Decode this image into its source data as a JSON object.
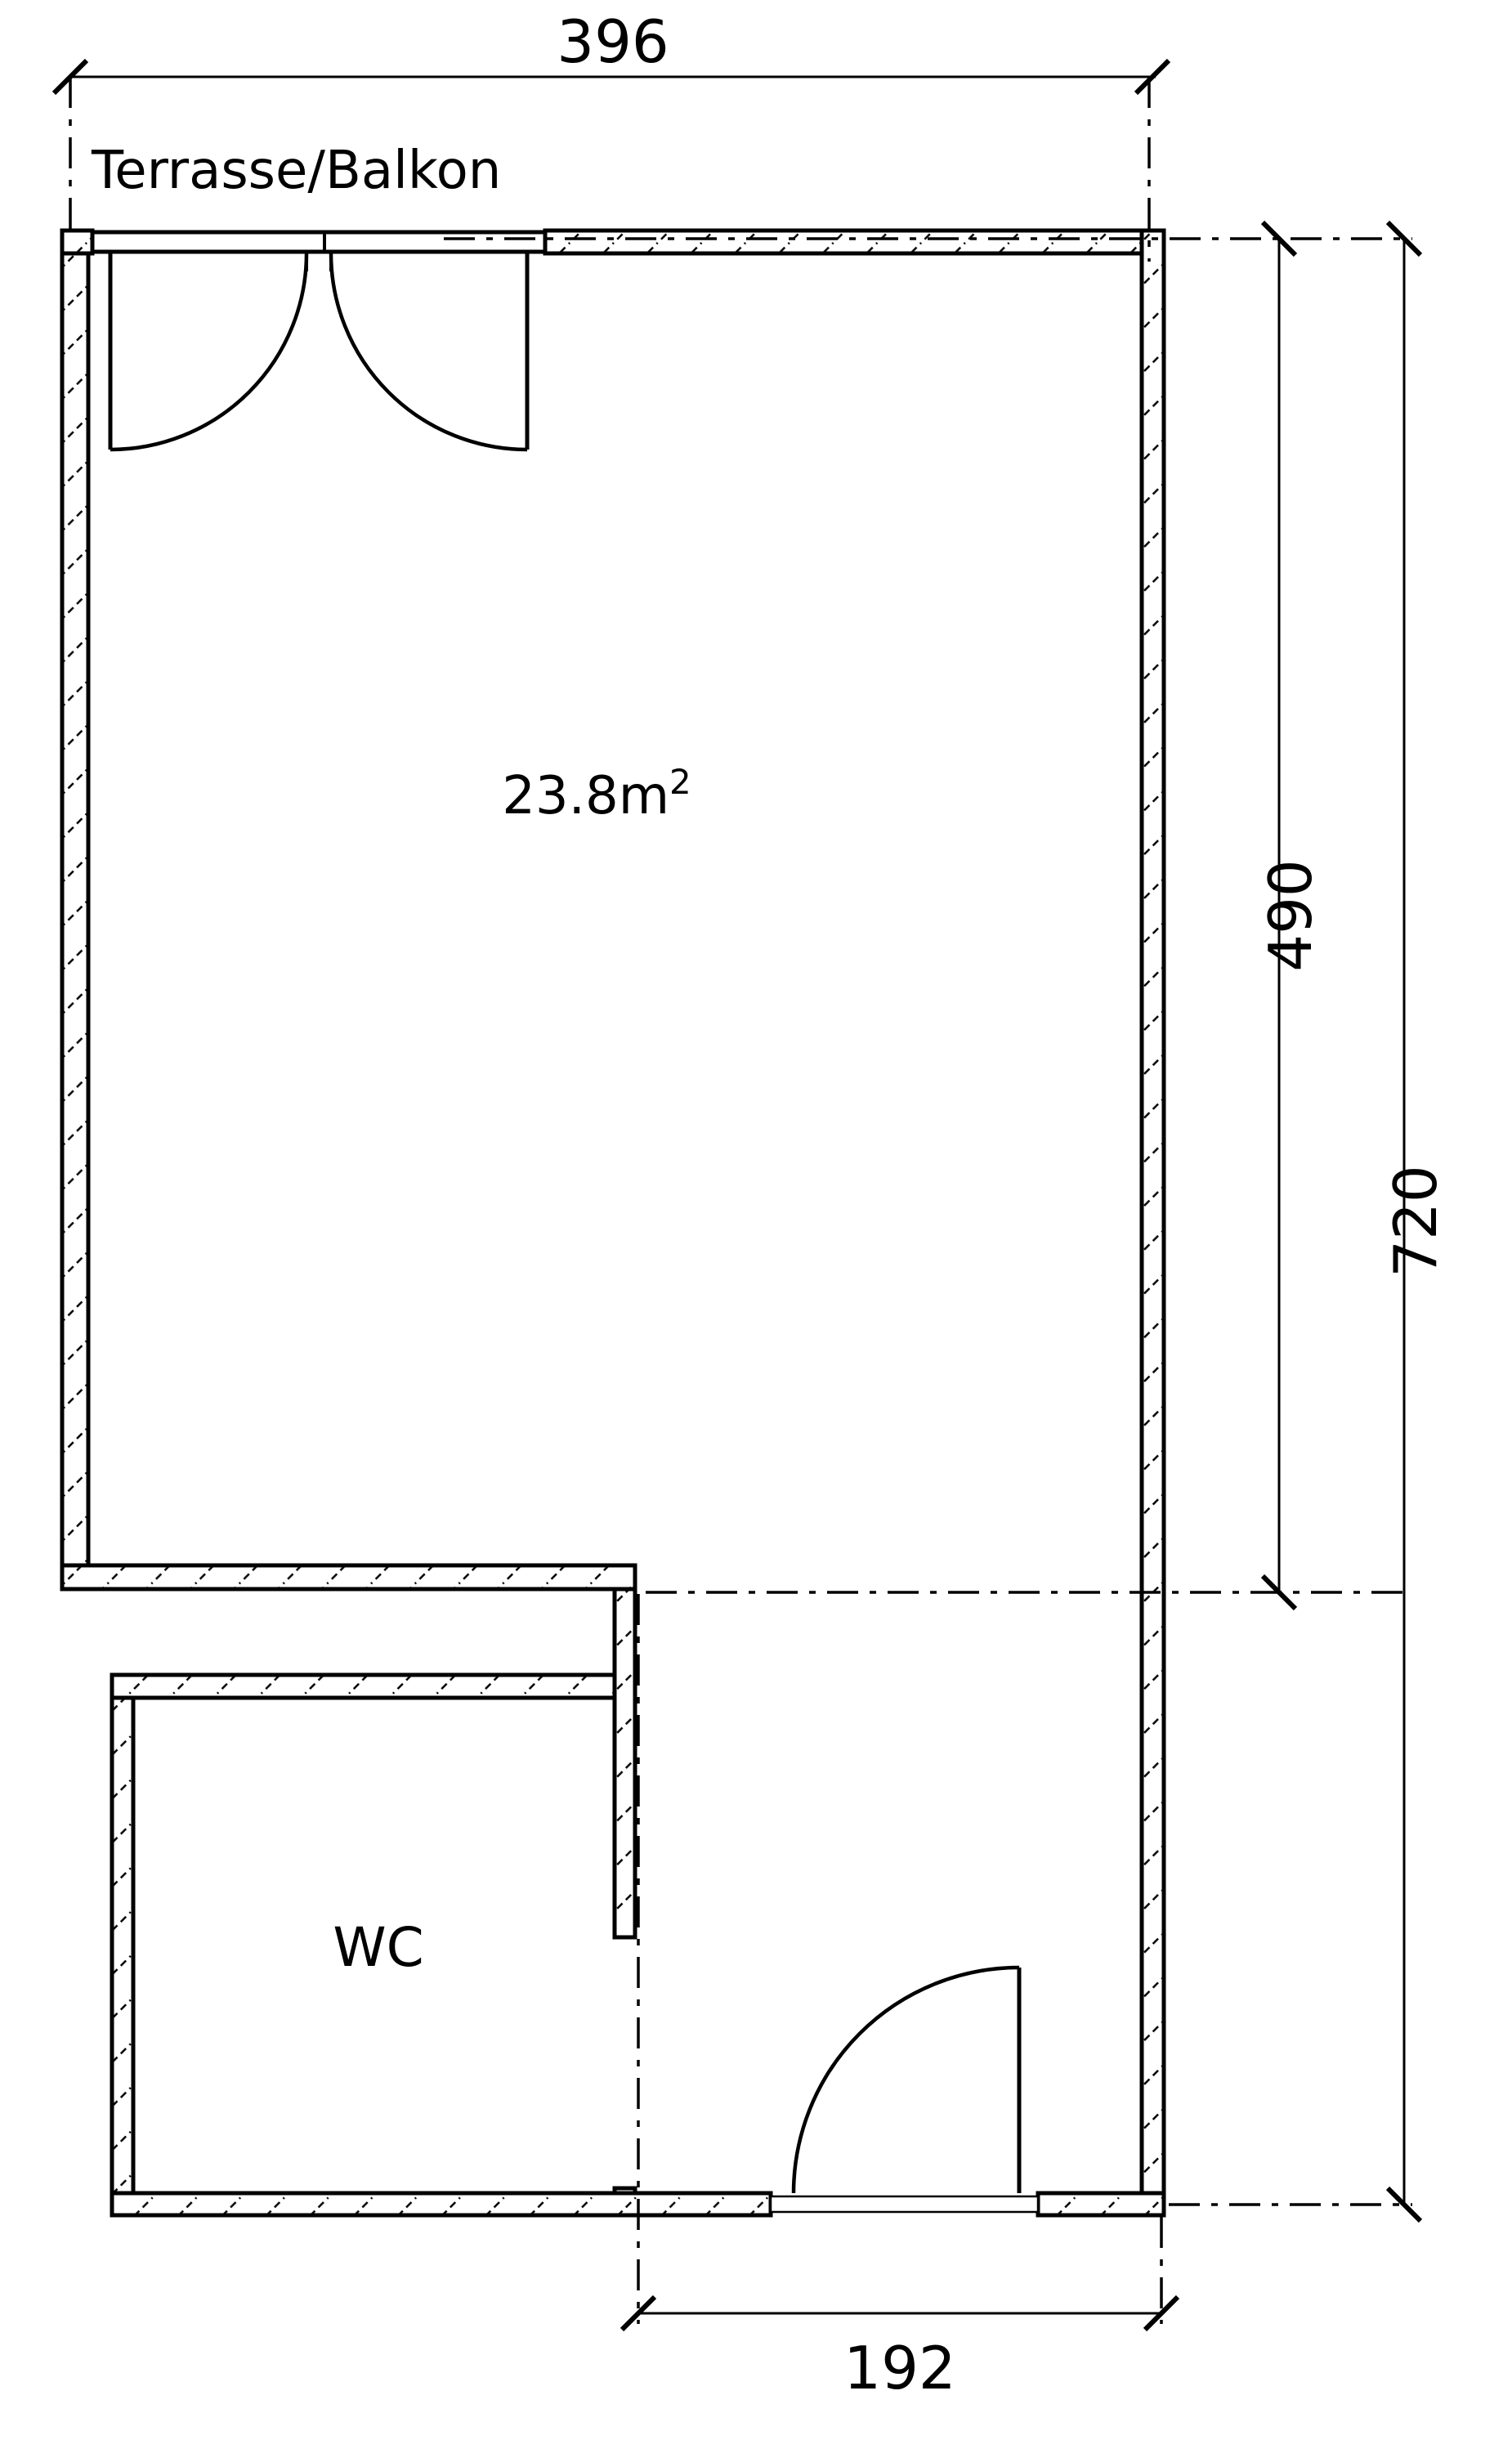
{
  "title": "Floor plan drawing",
  "colors": {
    "line": "#000000",
    "background": "#ffffff"
  },
  "labels": {
    "terrace": "Terrasse/Balkon",
    "area_value": "23.8m",
    "area_exponent": "2",
    "wc": "WC"
  },
  "dimensions": {
    "top_width": "396",
    "room_height": "490",
    "total_height": "720",
    "bottom_width": "192"
  }
}
